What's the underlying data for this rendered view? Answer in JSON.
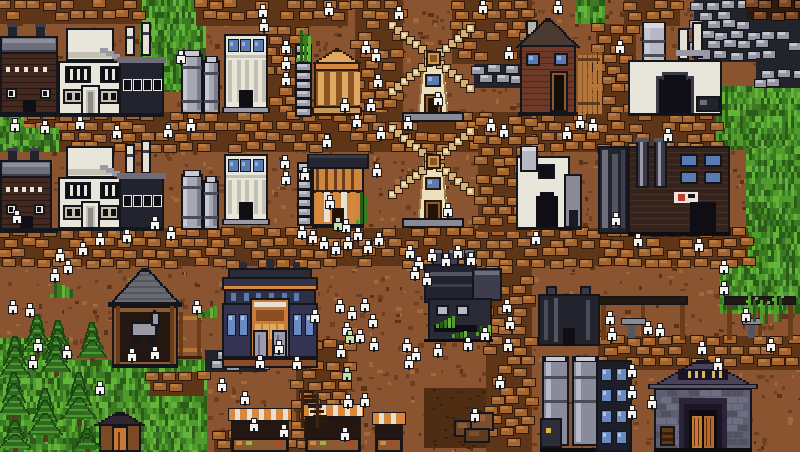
{
  "palette": {
    "dirt_base": "#8a5430",
    "dirt_dark": "#6e3f20",
    "dirt_darker": "#5c3317",
    "dirt_light": "#a0693c",
    "patch_dark": "#4f2d13",
    "patch_speck": "#3a2008",
    "grass": [
      "#3a7a22",
      "#4f9c2c",
      "#2c5d18",
      "#63b53a"
    ],
    "cobble": {
      "bg": "#5f3518",
      "fill": "#a26430",
      "hi": "#bd7c3e",
      "line": "#33190a"
    },
    "stone": {
      "bg": "#23232b",
      "fill": "#9898a4",
      "hi": "#c6c6d2",
      "line": "#15151c"
    },
    "ore_brown": {
      "bg": "#2e1a0c",
      "fill": "#7a4a28",
      "hi": "#95603a",
      "line": "#1a0e04"
    },
    "outline": "#15151c",
    "white_wall": "#e8e5da",
    "white_shade": "#c4c0b2",
    "chimney": "#e4e0d4",
    "metal_dark": "#23232e",
    "metal_mid": "#3d3d4e",
    "metal_light": "#6e6e7a",
    "steel": "#9a9aa6",
    "window_blue": "#5a7ab2",
    "window_blue_light": "#8fb0dc",
    "window_dark": "#0e0e14",
    "orange_wall": "#cd853f",
    "orange_dark": "#8a5420",
    "orange_light": "#e0a860",
    "awning_orange": "#d8883c",
    "awning_cream": "#e8e0d0",
    "wood": "#8a5a30",
    "wood_dark": "#5e3a1c",
    "wood_light": "#b5763a",
    "timber": "#6b3c1a",
    "door_orange": "#c87830",
    "roof_dark": "#262630",
    "tan": "#d8b070",
    "cream": "#ece0bc",
    "lattice": "#efe0b8",
    "hub": "#c89858",
    "brick_red": "#42281f",
    "brick_line": "#2a1810",
    "house_red": "#6e3a2a",
    "navy": "#32324a",
    "navy_light": "#343452",
    "trim_orange": "#d8883c",
    "grey_roof": "#6a6a74",
    "silo_body": "#a8a8b4",
    "silo_hi": "#c8c8d4",
    "silo_shade": "#7c7c8a",
    "silo_band": "#4a4a58",
    "stone_wall": "#5e5e72",
    "purple_roof": "#4a4258",
    "sign_bg": "#1a1424",
    "sign_gold": "#d8b85c",
    "tree_dark": "#1c4614",
    "tree_mid": "#2f6b1e",
    "tree_light": "#4e9630",
    "trunk": "#5a3a1e",
    "villager_fill": "#f4f3ee",
    "villager_line": "#17171d",
    "villager_green": "#c2e0ae",
    "horse": "#9a9aa4",
    "water": "#4a7ab2"
  },
  "scene": {
    "canvas": {
      "w": 800,
      "h": 452
    },
    "grass_zones": [
      [
        140,
        0,
        66,
        92
      ],
      [
        204,
        0,
        118,
        10
      ],
      [
        575,
        0,
        28,
        24
      ],
      [
        598,
        80,
        18,
        70
      ],
      [
        710,
        86,
        90,
        64
      ],
      [
        746,
        148,
        54,
        104
      ],
      [
        720,
        250,
        80,
        64
      ],
      [
        0,
        338,
        68,
        114
      ],
      [
        0,
        360,
        206,
        92
      ]
    ],
    "grass_over": [
      [
        0,
        108,
        22,
        44
      ],
      [
        14,
        128,
        44,
        24
      ]
    ],
    "dirt_patches": [
      [
        424,
        388,
        68,
        60
      ]
    ],
    "paths": [
      [
        0,
        0,
        142,
        24
      ],
      [
        196,
        0,
        152,
        26
      ],
      [
        624,
        0,
        56,
        26
      ],
      [
        355,
        0,
        48,
        118
      ],
      [
        452,
        0,
        80,
        64
      ],
      [
        266,
        26,
        36,
        90
      ],
      [
        596,
        24,
        40,
        92
      ],
      [
        0,
        112,
        716,
        40
      ],
      [
        0,
        228,
        748,
        38
      ],
      [
        478,
        116,
        54,
        116
      ],
      [
        486,
        266,
        46,
        186
      ],
      [
        296,
        340,
        52,
        112
      ],
      [
        150,
        372,
        54,
        24
      ],
      [
        214,
        430,
        84,
        22
      ],
      [
        598,
        336,
        202,
        34
      ]
    ],
    "stone_areas": [
      [
        205,
        350,
        62,
        22
      ],
      [
        694,
        0,
        106,
        62
      ],
      [
        756,
        58,
        44,
        30
      ],
      [
        474,
        64,
        48,
        24
      ]
    ],
    "ore_areas": [
      [
        748,
        0,
        52,
        20
      ]
    ],
    "entities": [
      {
        "type": "factory_dark",
        "x": 0,
        "y": 26,
        "w": 58,
        "h": 90
      },
      {
        "type": "factory_white",
        "x": 58,
        "y": 24,
        "w": 106,
        "h": 92
      },
      {
        "type": "silo",
        "x": 181,
        "y": 50,
        "w": 22,
        "h": 64
      },
      {
        "type": "silo",
        "x": 203,
        "y": 56,
        "w": 17,
        "h": 58
      },
      {
        "type": "temple_white",
        "x": 224,
        "y": 34,
        "w": 44,
        "h": 82
      },
      {
        "type": "pillar",
        "x": 295,
        "y": 44,
        "w": 17,
        "h": 72
      },
      {
        "type": "temple_orange",
        "x": 312,
        "y": 48,
        "w": 50,
        "h": 68
      },
      {
        "type": "windmill",
        "x": 386,
        "y": 22,
        "w": 94,
        "h": 100
      },
      {
        "type": "house_red",
        "x": 518,
        "y": 18,
        "w": 60,
        "h": 98
      },
      {
        "type": "fence",
        "x": 578,
        "y": 52,
        "w": 22,
        "h": 62
      },
      {
        "type": "furnace_top",
        "x": 628,
        "y": 20,
        "w": 94,
        "h": 96
      },
      {
        "type": "factory_dark",
        "x": 0,
        "y": 150,
        "w": 52,
        "h": 82
      },
      {
        "type": "factory_white",
        "x": 58,
        "y": 142,
        "w": 106,
        "h": 88
      },
      {
        "type": "silo",
        "x": 181,
        "y": 170,
        "w": 22,
        "h": 60
      },
      {
        "type": "silo",
        "x": 203,
        "y": 176,
        "w": 16,
        "h": 54
      },
      {
        "type": "temple_white",
        "x": 224,
        "y": 154,
        "w": 44,
        "h": 74
      },
      {
        "type": "pillar",
        "x": 297,
        "y": 162,
        "w": 15,
        "h": 66
      },
      {
        "type": "tavern",
        "x": 312,
        "y": 154,
        "w": 52,
        "h": 74
      },
      {
        "type": "windmill",
        "x": 386,
        "y": 124,
        "w": 94,
        "h": 104
      },
      {
        "type": "furnace_white",
        "x": 516,
        "y": 146,
        "w": 66,
        "h": 84
      },
      {
        "type": "dark_annex",
        "x": 598,
        "y": 146,
        "w": 30,
        "h": 88
      },
      {
        "type": "brick_factory",
        "x": 628,
        "y": 146,
        "w": 102,
        "h": 90
      },
      {
        "type": "foundry",
        "x": 424,
        "y": 250,
        "w": 78,
        "h": 92
      },
      {
        "type": "stable",
        "x": 110,
        "y": 268,
        "w": 70,
        "h": 100
      },
      {
        "type": "fence_h",
        "x": 178,
        "y": 312,
        "w": 24,
        "h": 52
      },
      {
        "type": "townhall",
        "x": 222,
        "y": 268,
        "w": 96,
        "h": 100
      },
      {
        "type": "workshop_stall",
        "x": 598,
        "y": 296,
        "w": 90,
        "h": 44
      },
      {
        "type": "workshop_stall",
        "x": 724,
        "y": 296,
        "w": 72,
        "h": 44
      },
      {
        "type": "dark_block",
        "x": 538,
        "y": 294,
        "w": 62,
        "h": 52
      },
      {
        "type": "tank_farm",
        "x": 540,
        "y": 356,
        "w": 60,
        "h": 96
      },
      {
        "type": "dark_tower",
        "x": 596,
        "y": 360,
        "w": 36,
        "h": 92
      },
      {
        "type": "inn",
        "x": 650,
        "y": 360,
        "w": 106,
        "h": 92
      },
      {
        "type": "stall_awning",
        "x": 230,
        "y": 408,
        "w": 60,
        "h": 44
      },
      {
        "type": "stall_awning",
        "x": 304,
        "y": 404,
        "w": 58,
        "h": 48
      },
      {
        "type": "stall_awning",
        "x": 374,
        "y": 412,
        "w": 30,
        "h": 40
      },
      {
        "type": "shed",
        "x": 94,
        "y": 412,
        "w": 52,
        "h": 40
      },
      {
        "type": "ladder",
        "x": 300,
        "y": 390,
        "w": 24,
        "h": 38
      },
      {
        "type": "rocks",
        "x": 452,
        "y": 410,
        "w": 44,
        "h": 34
      }
    ],
    "trees": [
      [
        2,
        336,
        26,
        46
      ],
      [
        24,
        314,
        26,
        44
      ],
      [
        46,
        320,
        24,
        40
      ],
      [
        44,
        336,
        24,
        40
      ],
      [
        0,
        372,
        28,
        50
      ],
      [
        30,
        388,
        30,
        54
      ],
      [
        64,
        372,
        30,
        54
      ],
      [
        80,
        322,
        24,
        40
      ],
      [
        74,
        428,
        26,
        24
      ],
      [
        0,
        420,
        30,
        32
      ]
    ],
    "bamboo": [
      [
        746,
        296,
        12,
        26
      ],
      [
        758,
        300,
        12,
        24
      ],
      [
        772,
        294,
        14,
        28
      ]
    ],
    "tufts": [
      [
        50,
        280,
        22,
        18
      ],
      [
        198,
        302,
        18,
        16
      ],
      [
        436,
        312,
        20,
        16
      ],
      [
        452,
        326,
        16,
        12
      ],
      [
        356,
        190,
        12,
        34
      ],
      [
        296,
        28,
        14,
        34
      ],
      [
        476,
        322,
        16,
        14
      ]
    ],
    "villagers": [
      [
        176,
        50
      ],
      [
        186,
        118
      ],
      [
        163,
        124
      ],
      [
        75,
        116
      ],
      [
        112,
        125
      ],
      [
        10,
        118
      ],
      [
        40,
        120
      ],
      [
        258,
        4
      ],
      [
        259,
        18
      ],
      [
        281,
        40
      ],
      [
        281,
        56
      ],
      [
        281,
        72
      ],
      [
        324,
        2
      ],
      [
        394,
        6
      ],
      [
        361,
        40
      ],
      [
        371,
        48
      ],
      [
        373,
        74
      ],
      [
        340,
        98
      ],
      [
        352,
        114
      ],
      [
        366,
        98
      ],
      [
        376,
        126
      ],
      [
        322,
        134
      ],
      [
        433,
        92
      ],
      [
        403,
        116
      ],
      [
        478,
        0
      ],
      [
        504,
        46
      ],
      [
        553,
        0
      ],
      [
        486,
        118
      ],
      [
        499,
        124
      ],
      [
        575,
        115
      ],
      [
        588,
        118
      ],
      [
        562,
        126
      ],
      [
        615,
        40
      ],
      [
        663,
        128
      ],
      [
        12,
        210
      ],
      [
        55,
        248
      ],
      [
        63,
        260
      ],
      [
        50,
        268
      ],
      [
        78,
        242
      ],
      [
        95,
        232
      ],
      [
        122,
        229
      ],
      [
        150,
        216
      ],
      [
        166,
        226
      ],
      [
        280,
        155
      ],
      [
        281,
        171
      ],
      [
        300,
        167
      ],
      [
        372,
        163
      ],
      [
        325,
        195
      ],
      [
        297,
        225
      ],
      [
        308,
        230
      ],
      [
        319,
        236
      ],
      [
        331,
        241
      ],
      [
        343,
        236
      ],
      [
        353,
        227
      ],
      [
        363,
        240
      ],
      [
        374,
        232
      ],
      [
        341,
        219
      ],
      [
        405,
        245
      ],
      [
        414,
        256
      ],
      [
        427,
        248
      ],
      [
        441,
        253
      ],
      [
        453,
        245
      ],
      [
        466,
        252
      ],
      [
        410,
        266
      ],
      [
        422,
        272
      ],
      [
        531,
        231
      ],
      [
        443,
        203
      ],
      [
        611,
        212
      ],
      [
        633,
        233
      ],
      [
        694,
        238
      ],
      [
        719,
        260
      ],
      [
        719,
        281
      ],
      [
        8,
        300
      ],
      [
        25,
        303
      ],
      [
        33,
        338
      ],
      [
        62,
        345
      ],
      [
        95,
        381
      ],
      [
        28,
        355
      ],
      [
        127,
        348
      ],
      [
        150,
        346
      ],
      [
        192,
        300
      ],
      [
        217,
        378
      ],
      [
        255,
        355
      ],
      [
        274,
        340
      ],
      [
        292,
        356
      ],
      [
        240,
        391
      ],
      [
        249,
        418
      ],
      [
        335,
        299
      ],
      [
        347,
        306
      ],
      [
        360,
        298
      ],
      [
        368,
        314
      ],
      [
        342,
        322
      ],
      [
        355,
        329
      ],
      [
        369,
        337
      ],
      [
        336,
        344
      ],
      [
        310,
        309
      ],
      [
        402,
        338
      ],
      [
        411,
        347
      ],
      [
        404,
        355
      ],
      [
        433,
        343
      ],
      [
        463,
        337
      ],
      [
        480,
        327
      ],
      [
        502,
        299
      ],
      [
        505,
        316
      ],
      [
        503,
        338
      ],
      [
        495,
        375
      ],
      [
        470,
        408
      ],
      [
        605,
        311
      ],
      [
        607,
        327
      ],
      [
        643,
        321
      ],
      [
        655,
        323
      ],
      [
        697,
        341
      ],
      [
        741,
        308
      ],
      [
        766,
        338
      ],
      [
        627,
        364
      ],
      [
        627,
        385
      ],
      [
        627,
        405
      ],
      [
        647,
        395
      ],
      [
        713,
        357
      ],
      [
        279,
        424
      ],
      [
        343,
        394
      ],
      [
        340,
        427
      ],
      [
        360,
        393
      ]
    ],
    "villagers_green": [
      [
        333,
        217
      ],
      [
        345,
        330
      ],
      [
        342,
        367
      ]
    ]
  }
}
